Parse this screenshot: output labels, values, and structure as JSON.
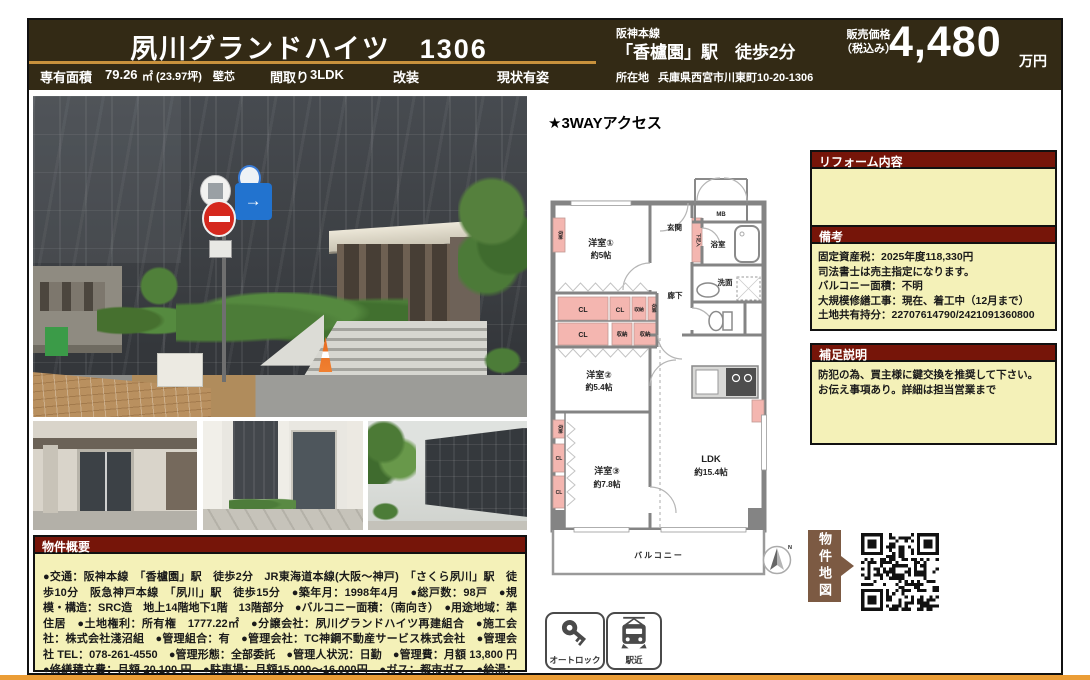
{
  "header": {
    "title": "夙川グランドハイツ　1306",
    "line_name": "阪神本線",
    "station_walk": "「香櫨園」駅　徒歩2分",
    "price_label": "販売価格",
    "price_tax": "（税込み）",
    "price_value": "4,480",
    "price_unit": "万円"
  },
  "subheader": {
    "area_label": "専有面積",
    "area_value": "79.26",
    "area_detail": "㎡ (23.97坪)　壁芯",
    "layout_label": "間取り",
    "layout_value": "3LDK",
    "renovation": "改装",
    "condition": "現状有姿",
    "address_label": "所在地",
    "address_value": "兵庫県西宮市川東町10-20-1306"
  },
  "floorplan": {
    "access_note": "★3WAYアクセス",
    "rooms": {
      "genkan": "玄関",
      "mb": "MB",
      "bath": "浴室",
      "wash": "洗面",
      "hall": "廊下",
      "shoe": "下足入",
      "room1": "洋室①",
      "room1_size": "約5帖",
      "room2": "洋室②",
      "room2_size": "約5.4帖",
      "room3": "洋室③",
      "room3_size": "約7.8帖",
      "ldk": "LDK",
      "ldk_size": "約15.4帖",
      "balcony": "バルコニー",
      "cl": "CL",
      "closet": "収納",
      "north": "N"
    }
  },
  "reform_box": {
    "title": "リフォーム内容",
    "body": ""
  },
  "notes_box": {
    "title": "備考",
    "lines": [
      "固定資産税：2025年度118,330円",
      "司法書士は売主指定になります。",
      "バルコニー面積：不明",
      "大規模修繕工事：現在、着工中（12月まで）",
      "土地共有持分：22707614790/2421091360800"
    ]
  },
  "supplement_box": {
    "title": "補足説明",
    "lines": [
      "防犯の為、買主様に鍵交換を推奨して下さい。",
      "お伝え事項あり。詳細は担当営業まで"
    ]
  },
  "overview_box": {
    "title": "物件概要",
    "body": "●交通：阪神本線　「香櫨園」駅　徒歩2分　JR東海道本線(大阪～神戸)　「さくら夙川」駅　徒歩10分　阪急神戸本線　「夙川」駅　徒歩15分　●築年月：1998年4月　●総戸数：98戸　●規模・構造：SRC造　地上14階地下1階　13階部分　●バルコニー面積：（南向き）　●用途地域：準住居　●土地権利：所有権　1777.22㎡　●分譲会社：夙川グランドハイツ再建組合　●施工会社：株式会社淺沼組　●管理組合：有　●管理会社：TC神鋼不動産サービス株式会社　●管理会社 TEL：078-261-4550　●管理形態：全部委託　●管理人状況：日勤　●管理費：月額 13,800 円　●修繕積立費：月額 20,100 円　●駐車場：月額15,000～16,000円　●ガス：都市ガス　●給湯：ガス給湯器　●現況：空家　●ペット：不可"
  },
  "map_badge": {
    "label": "物件地図"
  },
  "badges": {
    "autolock": "オートロック",
    "station_near": "駅近"
  },
  "colors": {
    "header_bg": "#332a15",
    "gold": "#c8913c",
    "box_title_bg": "#761509",
    "box_body_bg": "#f4f1b8",
    "accent_orange": "#eb9d36",
    "map_brown": "#7c5a43",
    "plan_pink": "#f4b6b0",
    "plan_wall": "#848484"
  }
}
